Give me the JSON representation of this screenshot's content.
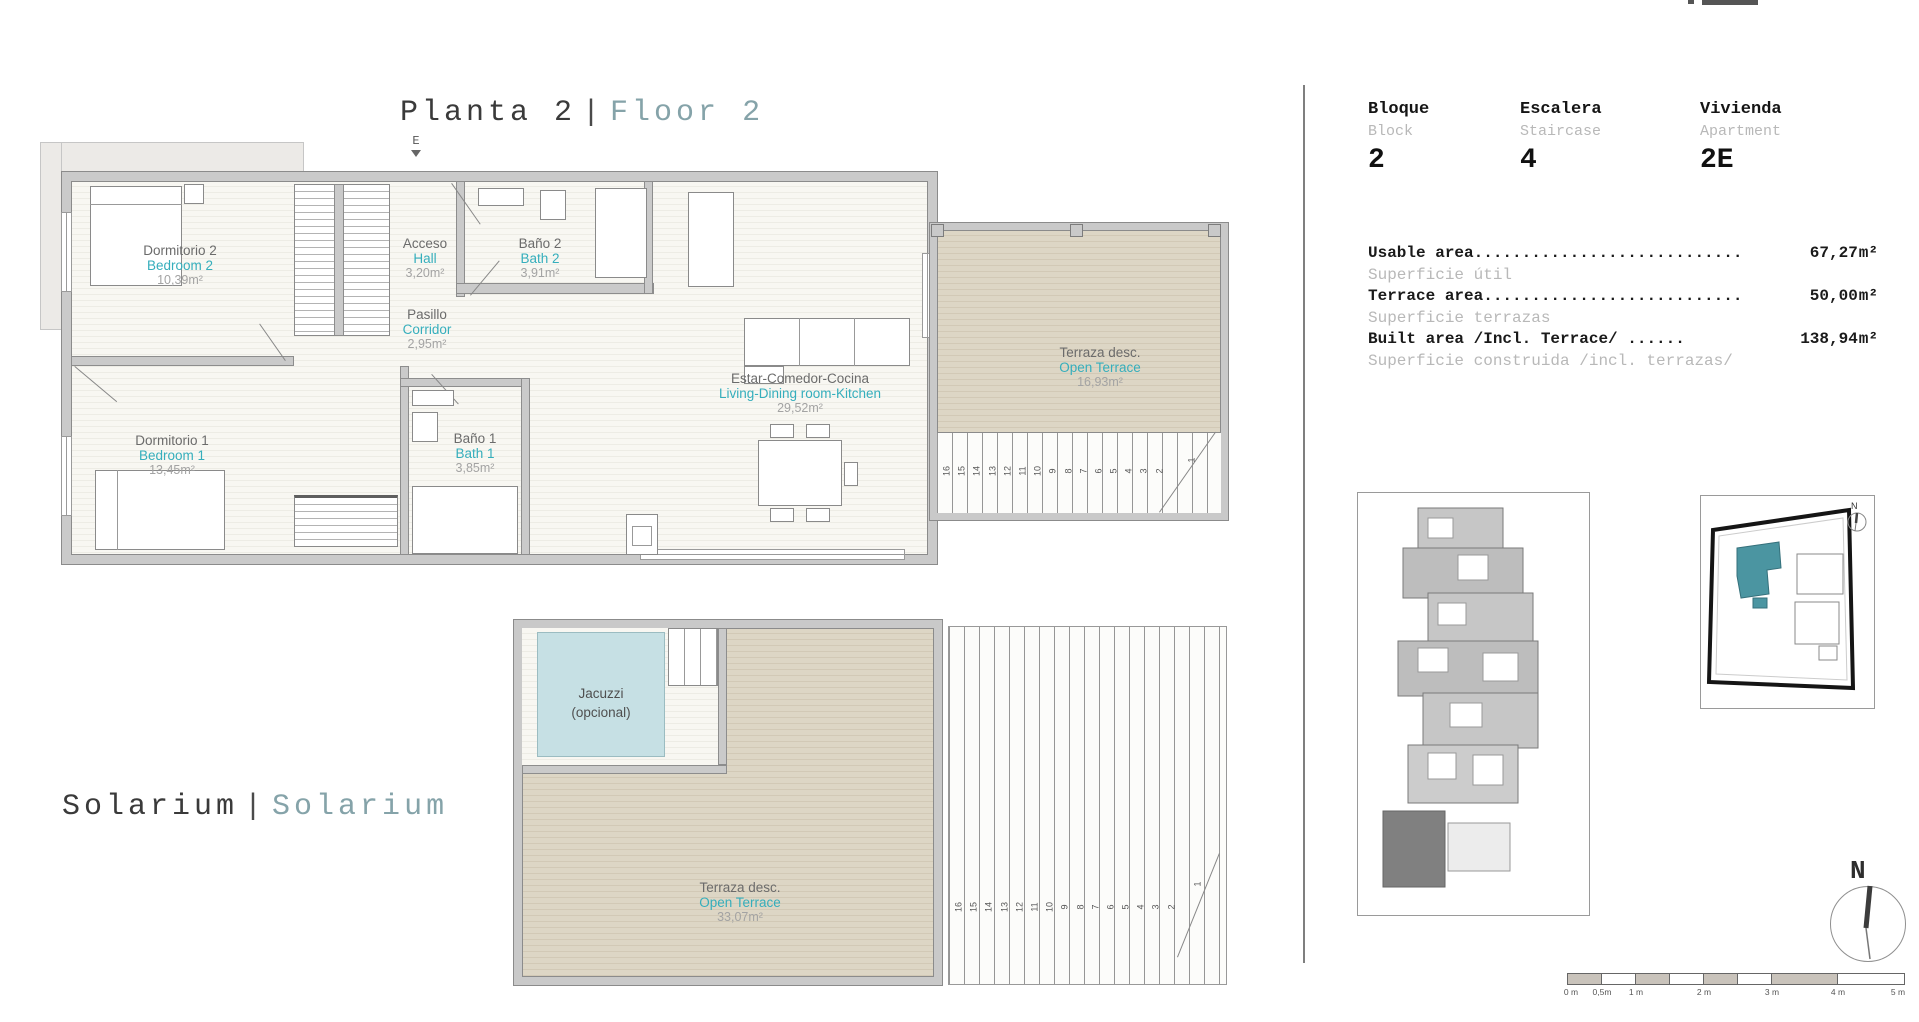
{
  "page": {
    "floor_title": {
      "primary": "Planta 2",
      "separator": "|",
      "secondary": "Floor 2"
    },
    "solarium_title": {
      "primary": "Solarium",
      "separator": "|",
      "secondary": "Solarium"
    }
  },
  "unit_info": {
    "bloque": {
      "label_es": "Bloque",
      "label_en": "Block",
      "value": "2"
    },
    "escalera": {
      "label_es": "Escalera",
      "label_en": "Staircase",
      "value": "4"
    },
    "vivienda": {
      "label_es": "Vivienda",
      "label_en": "Apartment",
      "value": "2E"
    }
  },
  "areas": {
    "usable": {
      "label_en": "Usable area............................",
      "value": "67,27",
      "unit": "m²",
      "label_es": "Superficie útil"
    },
    "terrace": {
      "label_en": "Terrace area...........................",
      "value": "50,00",
      "unit": "m²",
      "label_es": "Superficie terrazas"
    },
    "built": {
      "label_en": "Built area /Incl. Terrace/ ......",
      "value": "138,94",
      "unit": "m²",
      "label_es": "Superficie construida /incl. terrazas/"
    }
  },
  "floor_plan": {
    "entrance_label": "E",
    "rooms": {
      "bedroom2": {
        "es": "Dormitorio 2",
        "en": "Bedroom 2",
        "area": "10,39m²"
      },
      "hall": {
        "es": "Acceso",
        "en": "Hall",
        "area": "3,20m²"
      },
      "bath2": {
        "es": "Baño 2",
        "en": "Bath 2",
        "area": "3,91m²"
      },
      "corridor": {
        "es": "Pasillo",
        "en": "Corridor",
        "area": "2,95m²"
      },
      "living": {
        "es": "Estar-Comedor-Cocina",
        "en": "Living-Dining room-Kitchen",
        "area": "29,52m²"
      },
      "bedroom1": {
        "es": "Dormitorio 1",
        "en": "Bedroom 1",
        "area": "13,45m²"
      },
      "bath1": {
        "es": "Baño 1",
        "en": "Bath 1",
        "area": "3,85m²"
      },
      "terrace": {
        "es": "Terraza desc.",
        "en": "Open Terrace",
        "area": "16,93m²"
      }
    },
    "stairs": {
      "numbers": [
        "16",
        "15",
        "14",
        "13",
        "12",
        "11",
        "10",
        "9",
        "8",
        "7",
        "6",
        "5",
        "4",
        "3",
        "2"
      ],
      "first": "1"
    }
  },
  "solarium": {
    "jacuzzi": {
      "line1": "Jacuzzi",
      "line2": "(opcional)"
    },
    "terrace": {
      "es": "Terraza desc.",
      "en": "Open Terrace",
      "area": "33,07m²"
    },
    "stairs": {
      "numbers": [
        "16",
        "15",
        "14",
        "13",
        "12",
        "11",
        "10",
        "9",
        "8",
        "7",
        "6",
        "5",
        "4",
        "3",
        "2"
      ],
      "first": "1"
    }
  },
  "compass": {
    "north": "N"
  },
  "site_plan": {
    "north": "N"
  },
  "scale_bar": {
    "labels": [
      "0 m",
      "0,5m",
      "1 m",
      "2 m",
      "3 m",
      "4 m",
      "5 m"
    ]
  }
}
